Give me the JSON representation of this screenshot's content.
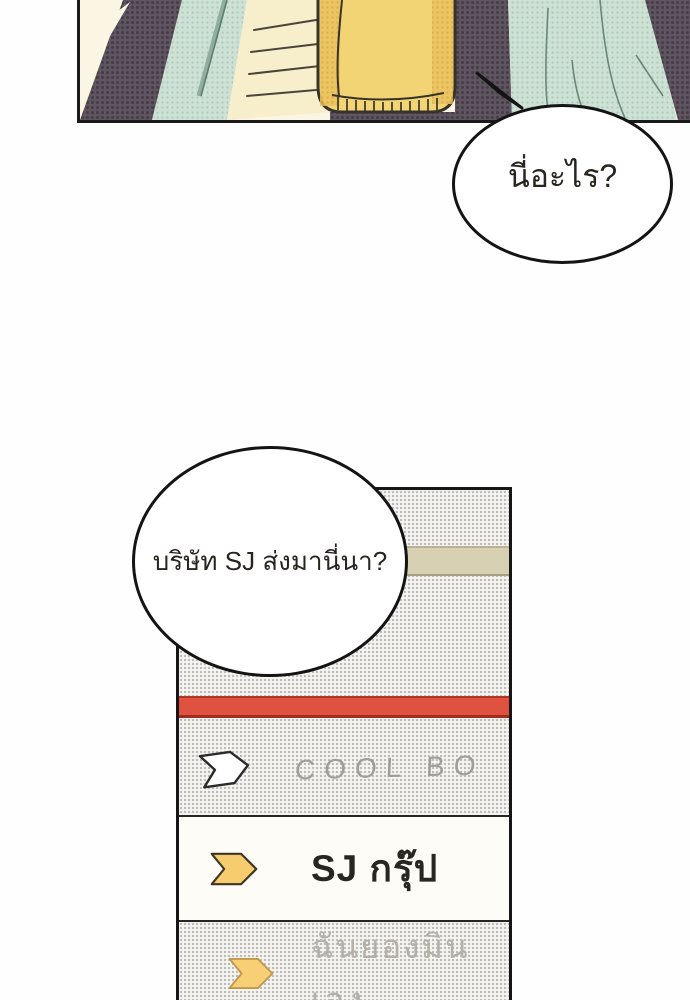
{
  "panel": {
    "colors": {
      "background": "#faf6e3",
      "jacket_purple": "#5e5560",
      "towel_teal": "#cde2d5",
      "skin": "#f7eecb",
      "cup_yellow": "#f3d475",
      "line": "#37332b"
    }
  },
  "speech_bubbles": [
    {
      "text": "นี่อะไร?"
    },
    {
      "text": "บริษัท SJ ส่งมานี่นา?"
    }
  ],
  "box": {
    "colors": {
      "texture_bg": "#f4f3f0",
      "texture_dot": "#bdbbb7",
      "tape_band": "#d8d0b3",
      "red_band": "#df5240",
      "label_bg": "#fdfcf6",
      "chevron_yellow": "#f7cc6e"
    },
    "rows": [
      {
        "icon": "chevron-white",
        "text": "COOL BO"
      },
      {
        "icon": "chevron-yellow",
        "text": "SJ กรุ๊ป"
      },
      {
        "icon": "chevron-yellow-faded",
        "text": "ฉันยองมินเอง"
      }
    ]
  }
}
